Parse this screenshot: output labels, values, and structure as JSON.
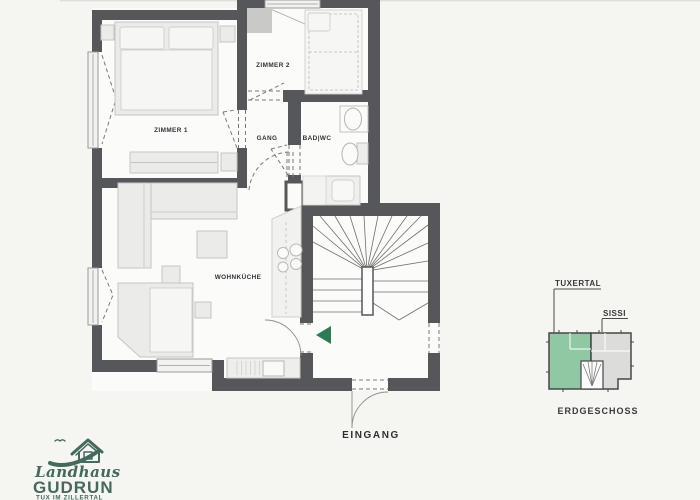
{
  "page": {
    "background": "#f5f5f2"
  },
  "colors": {
    "wall": "#56575b",
    "accent_green": "#2e7a54",
    "inset_green": "#8fc8a3",
    "inset_gray": "#dcdcda",
    "logo_green": "#46695e",
    "label": "#333336"
  },
  "plan": {
    "rooms": [
      {
        "id": "zimmer1",
        "label": "ZIMMER 1"
      },
      {
        "id": "zimmer2",
        "label": "ZIMMER 2"
      },
      {
        "id": "gang",
        "label": "GANG"
      },
      {
        "id": "bad",
        "label": "BAD|WC"
      },
      {
        "id": "wohnkueche",
        "label": "WOHNKÜCHE"
      }
    ],
    "entrance_label": "EINGANG"
  },
  "inset": {
    "unit_highlight": "TUXERTAL",
    "unit_other": "SISSI",
    "floor": "ERDGESCHOSS"
  },
  "logo": {
    "script": "Landhaus",
    "name": "GUDRUN",
    "tagline": "TUX IM ZILLERTAL"
  }
}
